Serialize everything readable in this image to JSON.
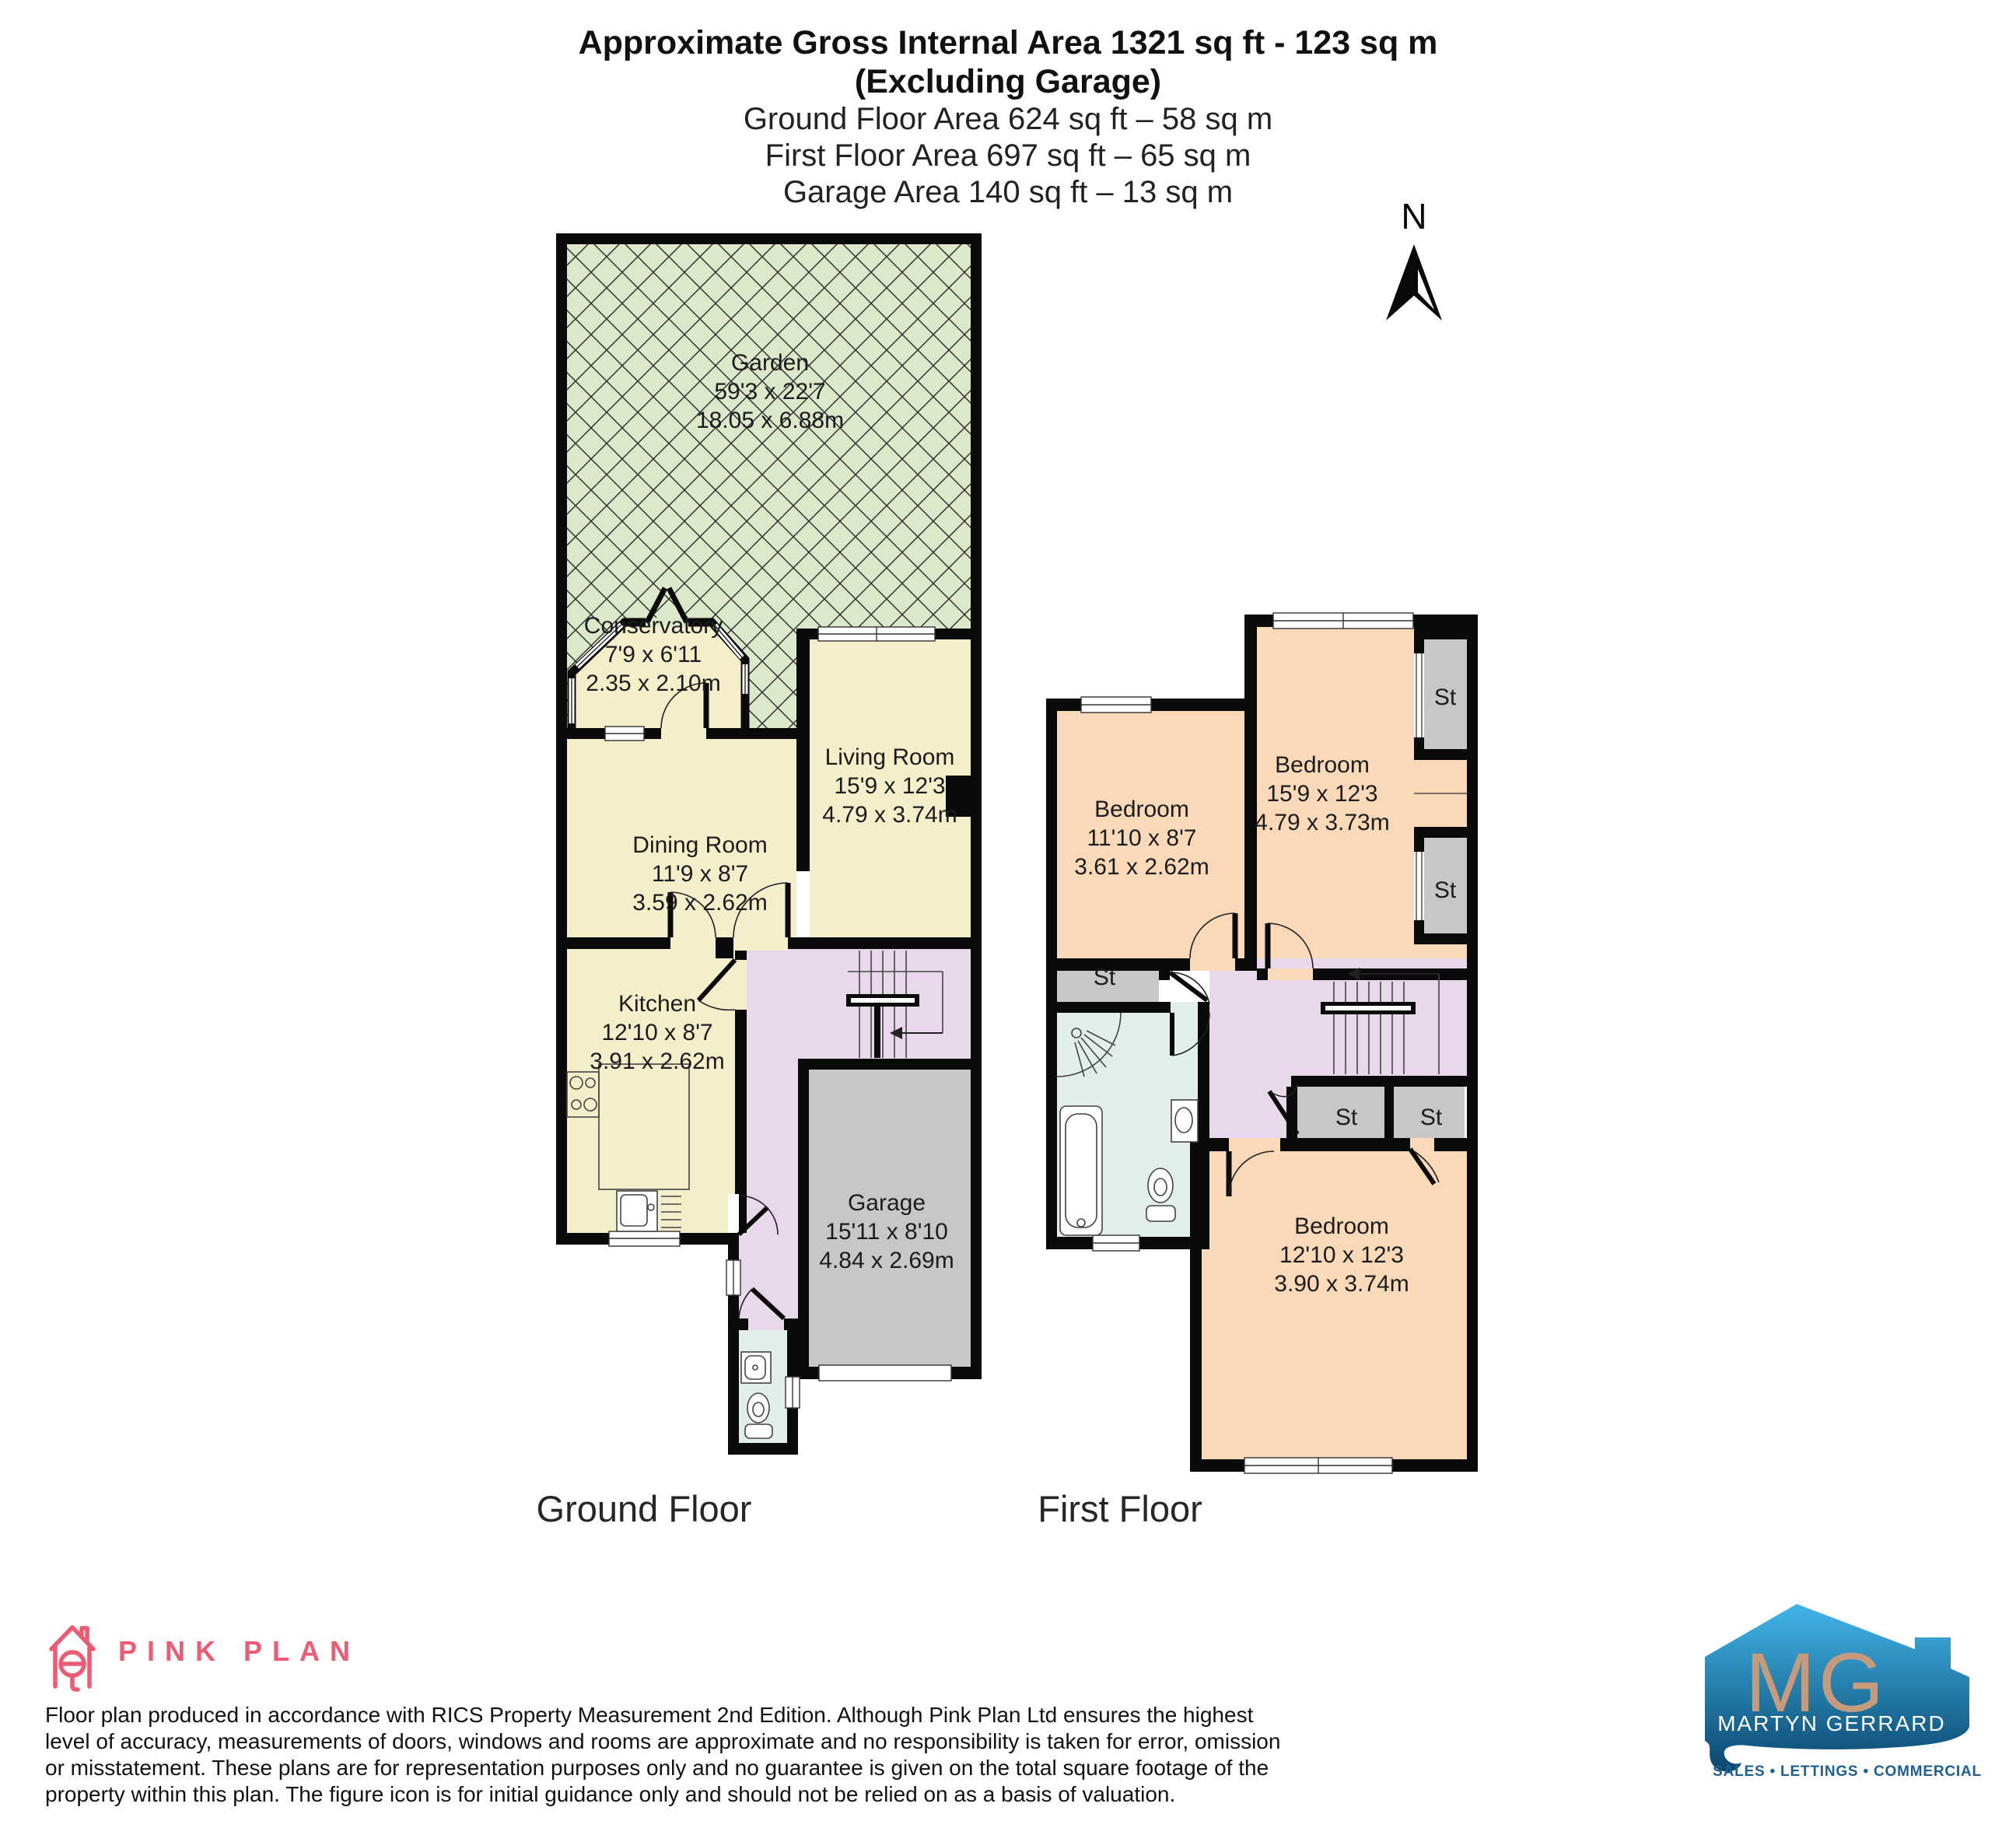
{
  "header": {
    "line1": "Approximate Gross Internal Area 1321 sq ft - 123 sq m",
    "line2": "(Excluding Garage)",
    "line3": "Ground Floor Area 624 sq ft – 58 sq m",
    "line4": "First Floor Area 697 sq ft – 65 sq m",
    "line5": "Garage Area 140 sq ft – 13 sq m"
  },
  "compass": {
    "north_label": "N"
  },
  "ground_floor": {
    "floor_label": "Ground Floor",
    "rooms": {
      "garden": {
        "name": "Garden",
        "imperial": "59'3 x 22'7",
        "metric": "18.05 x 6.88m"
      },
      "conservatory": {
        "name": "Conservatory",
        "imperial": "7'9 x 6'11",
        "metric": "2.35 x 2.10m"
      },
      "living_room": {
        "name": "Living Room",
        "imperial": "15'9 x 12'3",
        "metric": "4.79 x 3.74m"
      },
      "dining_room": {
        "name": "Dining Room",
        "imperial": "11'9 x 8'7",
        "metric": "3.59 x 2.62m"
      },
      "kitchen": {
        "name": "Kitchen",
        "imperial": "12'10 x 8'7",
        "metric": "3.91 x 2.62m"
      },
      "garage": {
        "name": "Garage",
        "imperial": "15'11 x 8'10",
        "metric": "4.84 x 2.69m"
      }
    }
  },
  "first_floor": {
    "floor_label": "First Floor",
    "st_label": "St",
    "rooms": {
      "bedroom_left": {
        "name": "Bedroom",
        "imperial": "11'10 x 8'7",
        "metric": "3.61 x 2.62m"
      },
      "bedroom_right": {
        "name": "Bedroom",
        "imperial": "15'9 x 12'3",
        "metric": "4.79 x 3.73m"
      },
      "bedroom_bottom": {
        "name": "Bedroom",
        "imperial": "12'10 x 12'3",
        "metric": "3.90 x 3.74m"
      }
    }
  },
  "footer": {
    "pinkplan_logo_text": "PINK PLAN",
    "disclaimer_line1": "Floor plan produced in accordance with RICS Property Measurement 2nd Edition. Although Pink Plan Ltd ensures the highest",
    "disclaimer_line2": "level of accuracy, measurements of doors, windows and rooms are approximate and no responsibility is taken for error, omission",
    "disclaimer_line3": "or misstatement. These plans are for representation purposes only and no guarantee is given on the total square footage of the",
    "disclaimer_line4": "property within this plan. The figure icon is for initial guidance only and should not be relied on as a basis of valuation.",
    "brand": {
      "initials": "MG",
      "name": "MARTYN GERRARD",
      "tagline": "SALES • LETTINGS • COMMERCIAL"
    }
  },
  "colors": {
    "wall": "#0a0a0a",
    "garden_green": "#dce8ca",
    "room_cream": "#f5eecb",
    "hall_purple": "#e9d8eb",
    "garage_grey": "#c7c7c7",
    "bedroom_peach": "#f9d9b7",
    "bath_blue": "#e1eeea",
    "pink_plan_pink": "#ed5c74",
    "mg_blue_light": "#41b6e8",
    "mg_blue_dark": "#0a466e",
    "mg_tan": "#c59b7c"
  }
}
